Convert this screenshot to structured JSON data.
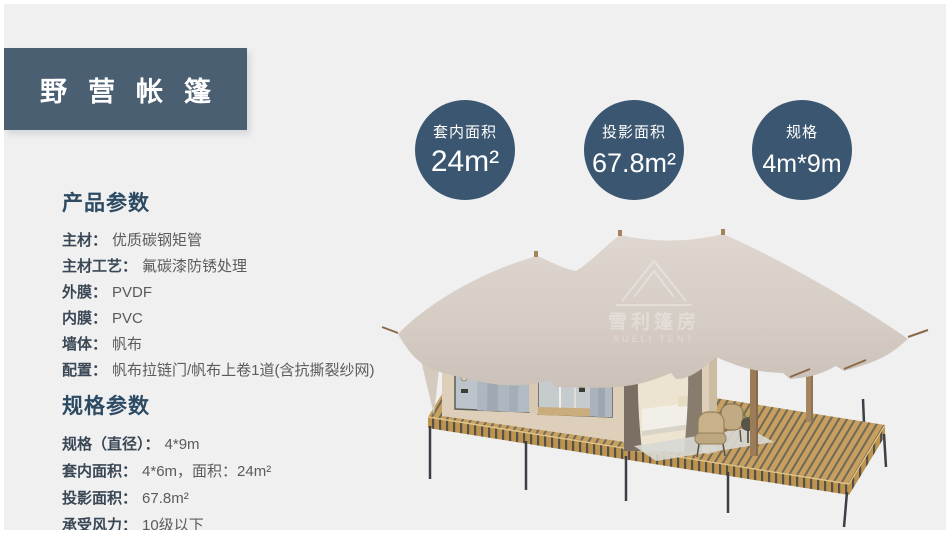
{
  "page": {
    "title": "野营帐篷"
  },
  "badges": [
    {
      "label": "套内面积",
      "value": "24m²"
    },
    {
      "label": "投影面积",
      "value": "67.8m²"
    },
    {
      "label": "规格",
      "value": "4m*9m"
    }
  ],
  "product_params": {
    "heading": "产品参数",
    "items": [
      {
        "label": "主材：",
        "value": "优质碳钢矩管"
      },
      {
        "label": "主材工艺：",
        "value": "氟碳漆防锈处理"
      },
      {
        "label": "外膜：",
        "value": "PVDF"
      },
      {
        "label": "内膜：",
        "value": "PVC"
      },
      {
        "label": "墙体：",
        "value": "帆布"
      },
      {
        "label": "配置：",
        "value": "帆布拉链门/帆布上卷1道(含抗撕裂纱网)"
      }
    ]
  },
  "spec_params": {
    "heading": "规格参数",
    "items": [
      {
        "label": "规格（直径）：",
        "value": "4*9m"
      },
      {
        "label": "套内面积：",
        "value": "4*6m，面积：24m²"
      },
      {
        "label": "投影面积：",
        "value": "67.8m²"
      },
      {
        "label": "承受风力：",
        "value": "10级以下"
      }
    ]
  },
  "watermark": {
    "line1": "雪利篷房",
    "line2": "XUELI TENT"
  },
  "colors": {
    "background": "#f0f0f1",
    "banner": "#4a5f72",
    "badge": "#3a5670",
    "heading": "#2d4a63",
    "label": "#3a4754",
    "value": "#5b5b5b",
    "roof": "#d6cdc5",
    "deck": "#c79f5f"
  }
}
